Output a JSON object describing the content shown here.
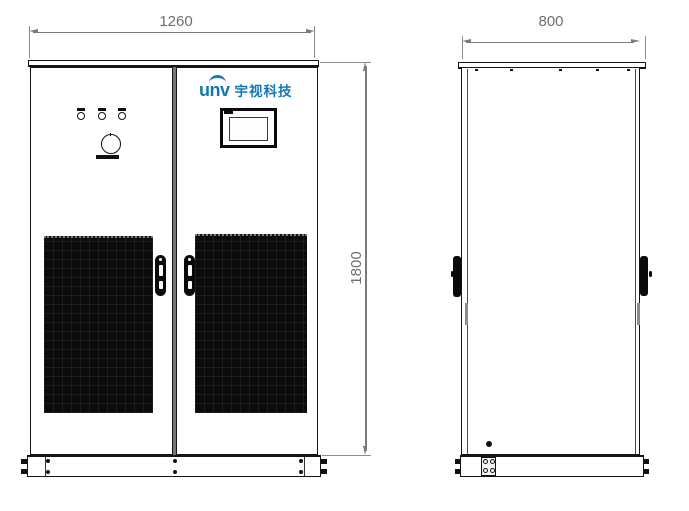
{
  "dimensions": {
    "width_front": "1260",
    "depth_side": "800",
    "height": "1800"
  },
  "logo": {
    "brand": "unv",
    "company": "宇视科技",
    "color": "#1577b2"
  },
  "colors": {
    "line": "#151515",
    "dimension_gray": "#7b7b7b",
    "grille_black": "#0b0b0b"
  }
}
